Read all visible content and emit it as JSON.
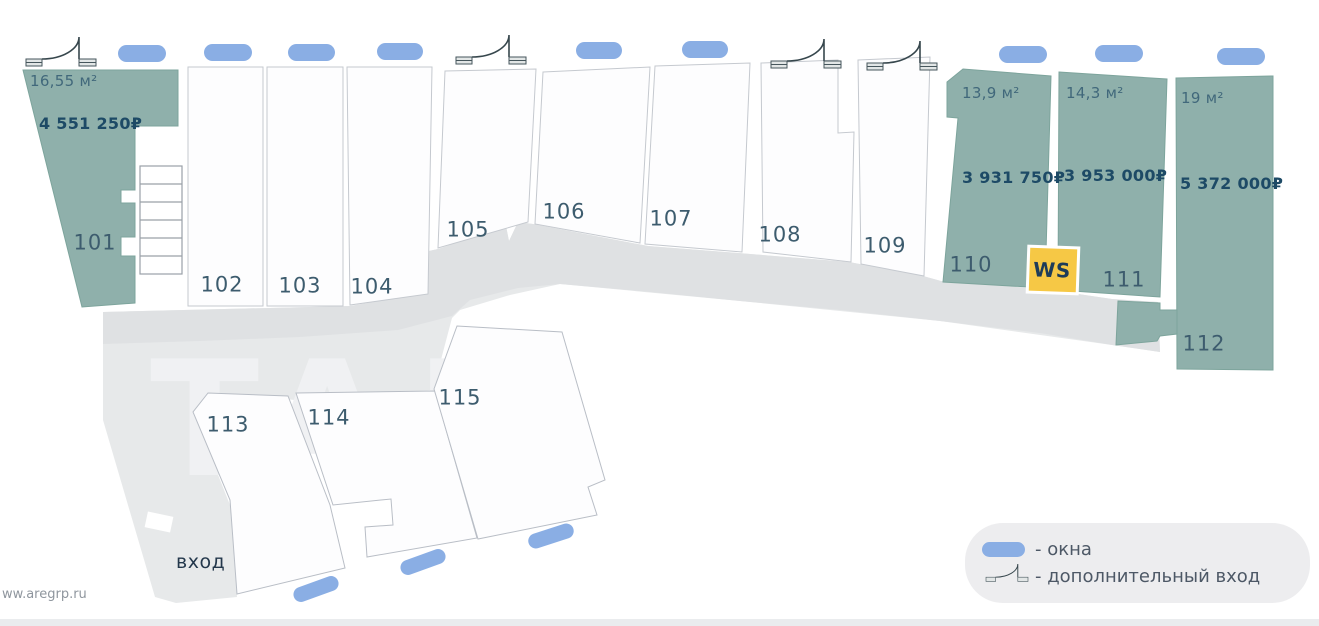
{
  "plan": {
    "entrance_label": "вход",
    "ws_label": "WS",
    "units": [
      {
        "number": "101",
        "area": "16,55 м²",
        "price": "4 551 250₽",
        "highlighted": true
      },
      {
        "number": "102",
        "highlighted": false
      },
      {
        "number": "103",
        "highlighted": false
      },
      {
        "number": "104",
        "highlighted": false
      },
      {
        "number": "105",
        "highlighted": false
      },
      {
        "number": "106",
        "highlighted": false
      },
      {
        "number": "107",
        "highlighted": false
      },
      {
        "number": "108",
        "highlighted": false
      },
      {
        "number": "109",
        "highlighted": false
      },
      {
        "number": "110",
        "area": "13,9 м²",
        "price": "3 931 750₽",
        "highlighted": true
      },
      {
        "number": "111",
        "area": "14,3 м²",
        "price": "3 953 000₽",
        "highlighted": true
      },
      {
        "number": "112",
        "area": "19 м²",
        "price": "5 372 000₽",
        "highlighted": true
      },
      {
        "number": "113",
        "highlighted": false
      },
      {
        "number": "114",
        "highlighted": false
      },
      {
        "number": "115",
        "highlighted": false
      }
    ]
  },
  "legend": {
    "window_label": "- окна",
    "door_label": "- дополнительный вход"
  },
  "watermark": {
    "site": "ww.aregrp.ru",
    "letters": "ТАЛ"
  },
  "colors": {
    "unit_highlight": "#8fb0ab",
    "unit_stroke": "#7da49c",
    "window": "#8aaee4",
    "ws_badge": "#f6c845",
    "corridor": "#dfe1e3",
    "floor": "#e7e9ea",
    "text_dark": "#1d4a66",
    "text_number": "#3d5c6e"
  }
}
